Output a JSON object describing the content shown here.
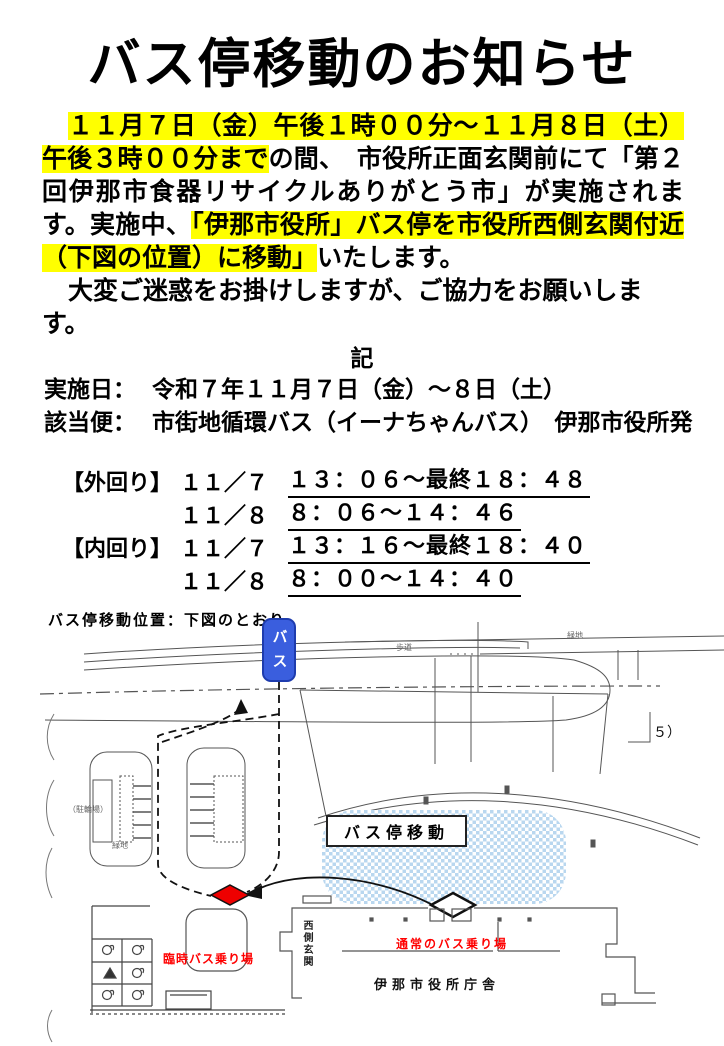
{
  "notice": {
    "title": "バス停移動のお知らせ",
    "intro": {
      "highlight1": "１１月７日（金）午後１時００分～１１月８日（土）午後３時００分まで",
      "text1": "の間、　市役所正面玄関前にて「第２回伊那市食器リサイクルありがとう市」が実施されます。実施中、",
      "highlight2": "「伊那市役所」バス停を市役所西側玄関付近（下図の位置）に移動」",
      "text2": "いたします。"
    },
    "apology": "大変ご迷惑をお掛けしますが、ご協力をお願いします。",
    "record_heading": "記",
    "details": [
      {
        "label": "実施日：",
        "value": "令和７年１１月７日（金）～８日（土）"
      },
      {
        "label": "該当便：",
        "value": "市街地循環バス（イーナちゃんバス）　伊那市役所発"
      }
    ],
    "schedule": [
      {
        "route": "【外回り】",
        "day": "１１／７",
        "time": "１３：０６～最終１８：４８"
      },
      {
        "route": "",
        "day": "１１／８",
        "time": "８：０６～１４：４６"
      },
      {
        "route": "【内回り】",
        "day": "１１／７",
        "time": "１３：１６～最終１８：４０"
      },
      {
        "route": "",
        "day": "１１／８",
        "time": "８：００～１４：４０"
      }
    ],
    "map_caption": "バス停移動位置：下図のとおり"
  },
  "map": {
    "bus_marker": "バス",
    "relocation_label": "バス停移動",
    "temp_stop": "臨時バス乗り場",
    "normal_stop": "通常のバス乗り場",
    "west_entrance": "西側玄関",
    "city_hall": "伊那市役所庁舎",
    "sidewalk": "歩道",
    "green_area_right": "緑地",
    "green_area_left": "緑地",
    "bicycle_parking": "（駐輪場）",
    "note_right": "５）"
  },
  "colors": {
    "highlight": "#ffff00",
    "bus_marker_bg": "#3a5ede",
    "map_red": "#ff0000",
    "map_zone_blue": "#b9d7ef"
  }
}
